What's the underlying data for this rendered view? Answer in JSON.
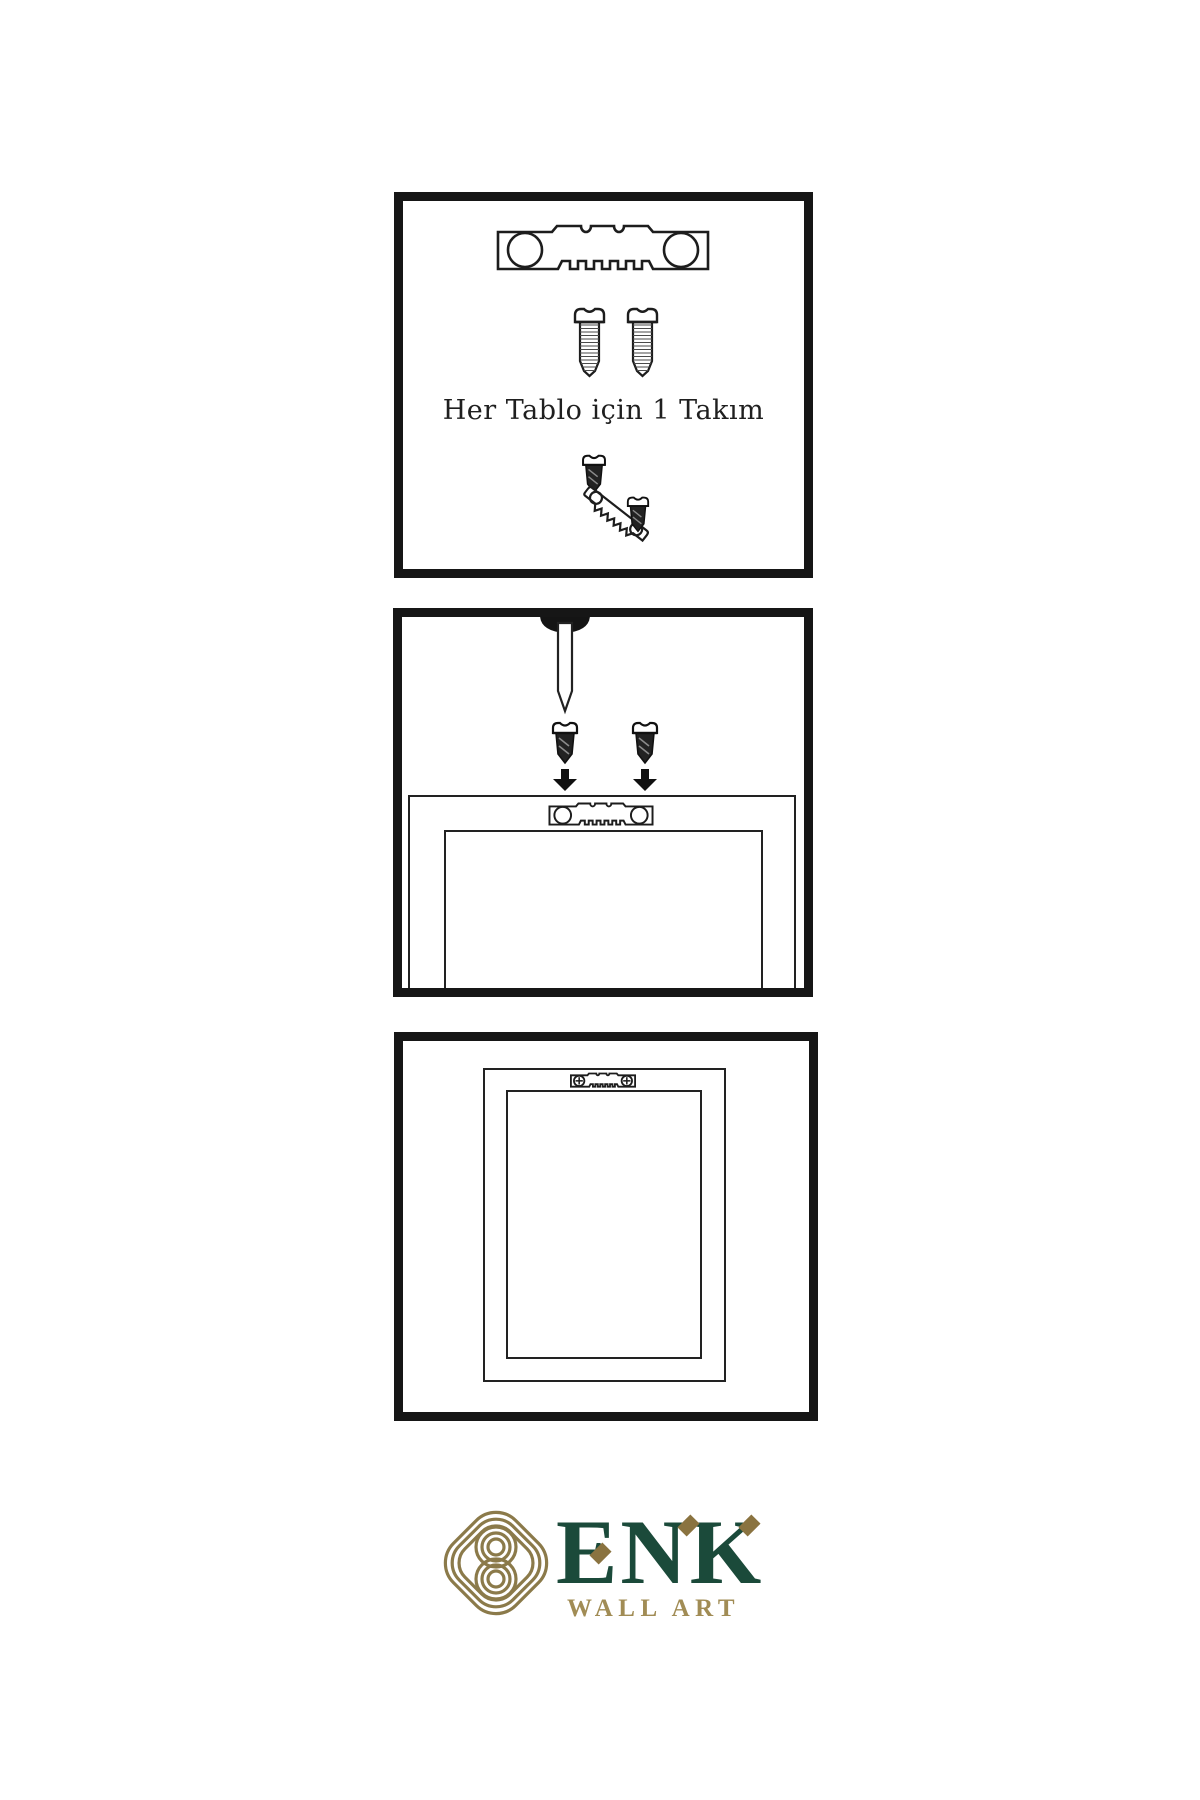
{
  "colors": {
    "panel_border": "#161616",
    "line": "#1d1d1d",
    "screw_dark_fill": "#232323",
    "brand_green": "#1b4a3a",
    "brand_gold_knot": "#8b7a4a",
    "subtitle_gold": "#a18c55",
    "diamond_gold": "#8a7340"
  },
  "step1": {
    "caption": "Her Tablo için 1 Takım"
  },
  "logo": {
    "brand": "ENK",
    "subtitle": "WALL ART"
  }
}
